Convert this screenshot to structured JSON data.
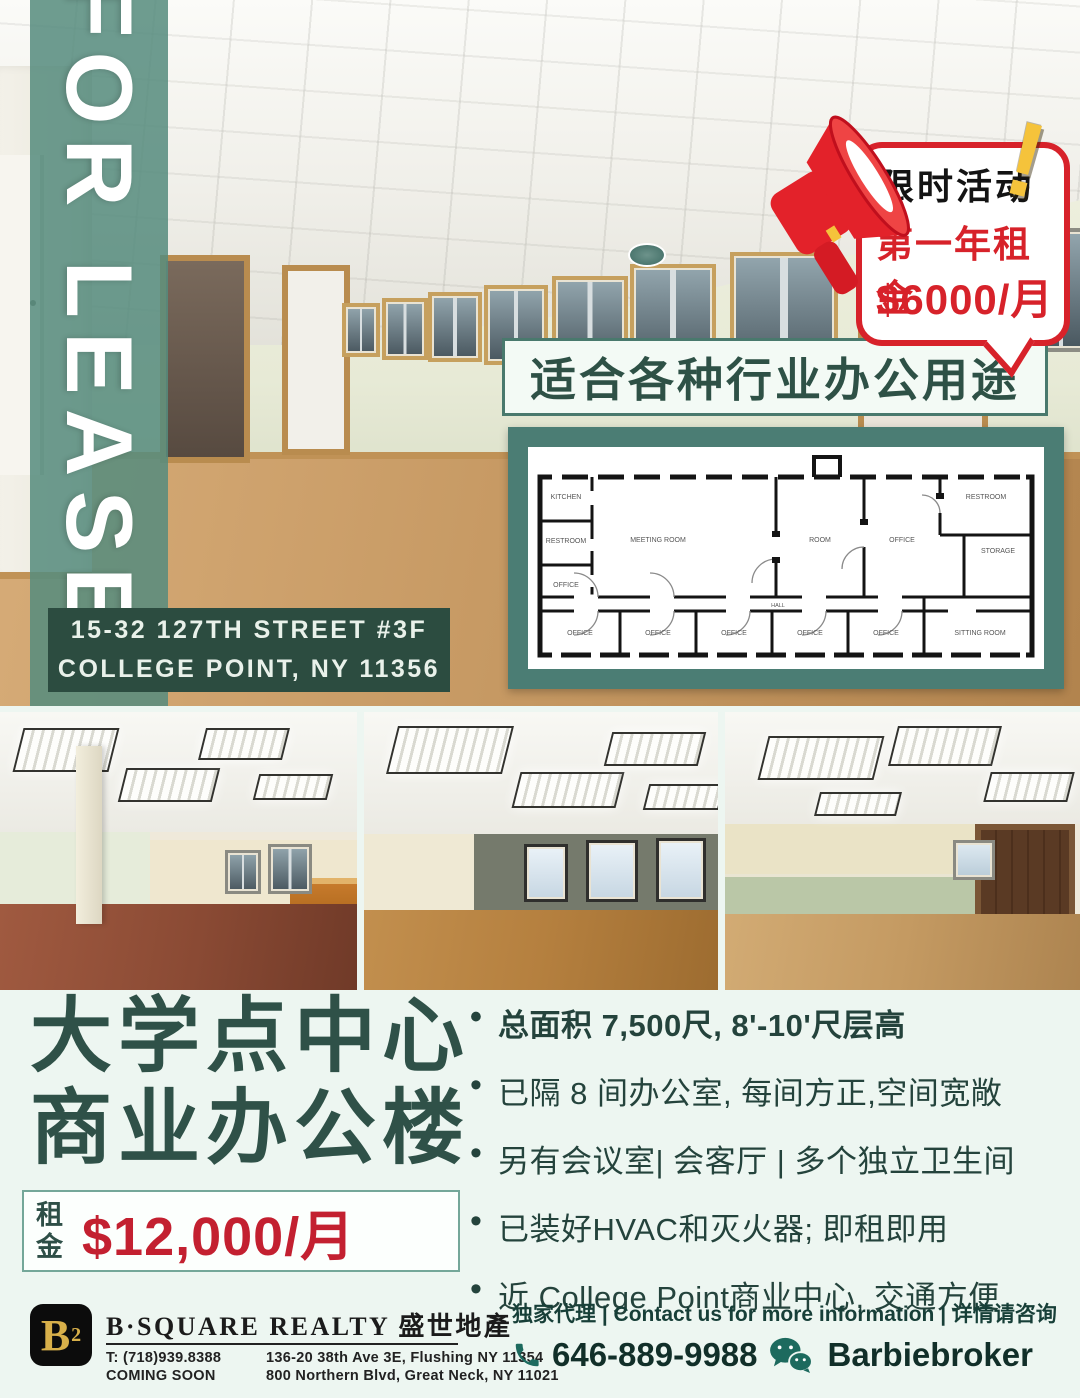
{
  "colors": {
    "teal_band": "#53897c",
    "teal_dark": "#2c4c40",
    "banner_text": "#2e5146",
    "red": "#d7222a",
    "yellow": "#f5c33b",
    "mint_bg": "#edf6f1",
    "gold": "#d8b04a",
    "footer_teal": "#1d6a5e"
  },
  "hero": {
    "for_lease": "FOR LEASE",
    "address_line1": "15-32 127TH STREET #3F",
    "address_line2": "COLLEGE POINT, NY 11356"
  },
  "promo": {
    "header": "限时活动",
    "exclamation": "!",
    "line1": "第一年租金",
    "line2": "$6000/月"
  },
  "banner": {
    "text": "适合各种行业办公用途"
  },
  "plan": {
    "labels": [
      "MEETING ROOM",
      "KITCHEN",
      "RESTROOM",
      "OFFICE",
      "ROOM",
      "OFFICE",
      "RESTROOM",
      "STORAGE",
      "HALL",
      "OFFICE",
      "OFFICE",
      "OFFICE",
      "OFFICE",
      "OFFICE",
      "SITTING ROOM"
    ]
  },
  "info": {
    "title_line1": "大学点中心",
    "title_line2": "商业办公楼",
    "rent_label": "租金",
    "rent_price": "$12,000/月",
    "bullets": [
      "总面积 7,500尺, 8'-10'尺层高",
      "已隔 8 间办公室, 每间方正,空间宽敞",
      "另有会议室| 会客厅 | 多个独立卫生间",
      "已装好HVAC和灭火器; 即租即用",
      "近 College Point商业中心, 交通方便"
    ]
  },
  "footer": {
    "logo_b": "B",
    "logo_sup": "2",
    "brand": "B·SQUARE REALTY 盛世地產",
    "tel": "T: (718)939.8388",
    "coming_soon": "COMING SOON",
    "addr1": "136-20 38th Ave 3E, Flushing NY 11354",
    "addr2": "800 Northern Blvd, Great Neck, NY 11021",
    "contact_line": "独家代理 | Contact us for more information | 详情请咨询",
    "phone": "646-889-9988",
    "wechat": "Barbiebroker"
  }
}
